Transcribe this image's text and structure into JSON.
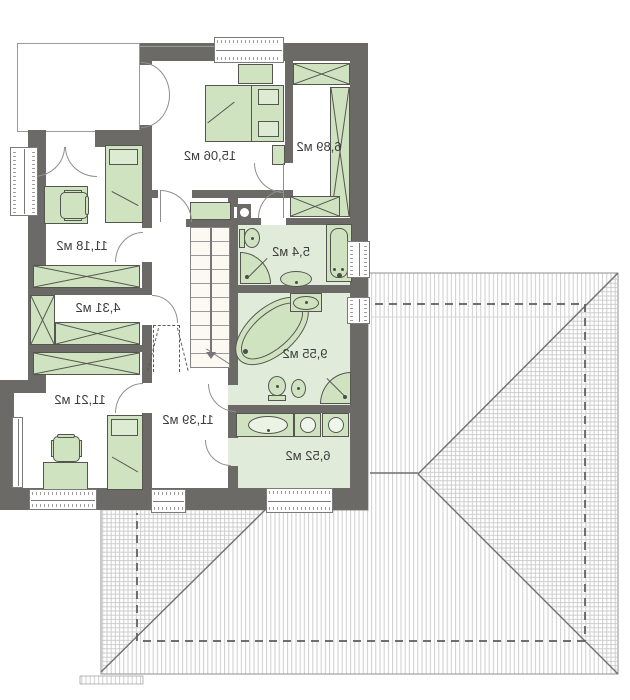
{
  "plan": {
    "title": "attic-floor-plan",
    "rooms": [
      {
        "name": "bedroom",
        "label": "15,06 м2"
      },
      {
        "name": "wardrobe",
        "label": "6,89 м2"
      },
      {
        "name": "child-room-1",
        "label": "11,18 м2"
      },
      {
        "name": "closet",
        "label": "4,31 м2"
      },
      {
        "name": "child-room-2",
        "label": "11,21 м2"
      },
      {
        "name": "hall",
        "label": "11,39 м2"
      },
      {
        "name": "bathroom-small",
        "label": "5,4 м2"
      },
      {
        "name": "bathroom-large",
        "label": "9,55 м2"
      },
      {
        "name": "laundry",
        "label": "6,52 м2"
      }
    ],
    "colors": {
      "wall": "#6b6a67",
      "furniture_fill": "#cfe3c1",
      "furniture_stroke": "#55564f",
      "bathroom_floor": "#e0ecd9",
      "roof_hatch": "#c8c8c8",
      "dashed_line": "#5c5c5c",
      "label_text": "#3e3e3e"
    },
    "text_direction": "mirrored"
  }
}
